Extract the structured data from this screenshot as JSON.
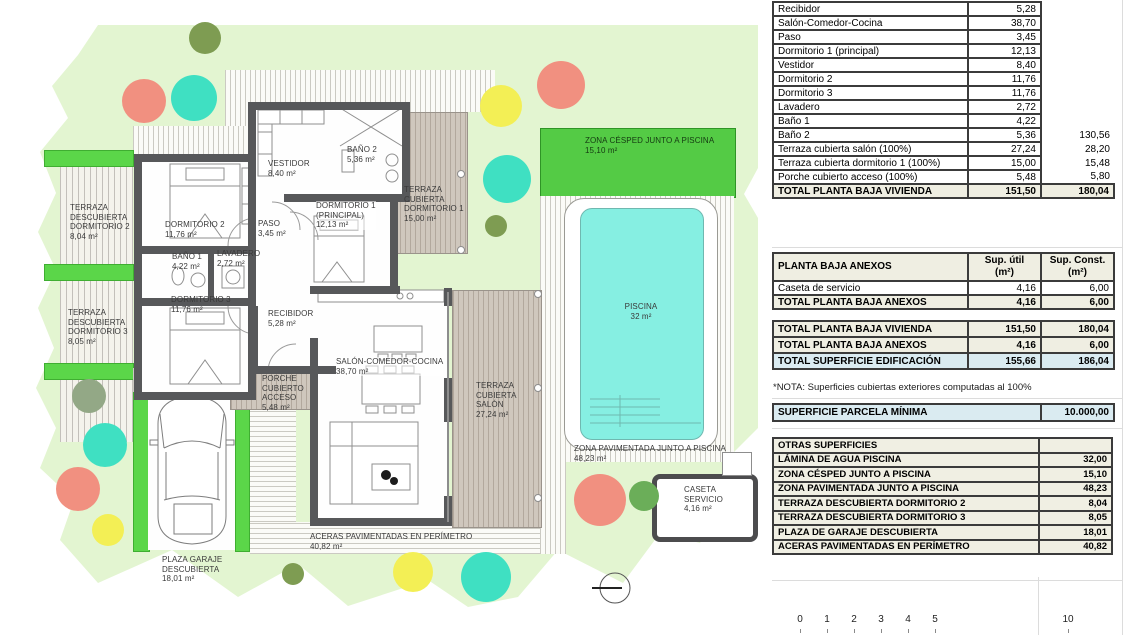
{
  "colors": {
    "parcel": "#e3f5d1",
    "cesped": "#54cb45",
    "green_bar": "#5bd649",
    "pool_water": "#86efe2",
    "wall": "#57585a",
    "roofed_terrace": "#cfc7bd",
    "table_beige": "#efeee2",
    "table_blue": "#daebf1",
    "tree_salmon": "#f19080",
    "tree_teal": "#3fe0c2",
    "tree_yellow": "#f3ef55",
    "tree_olive": "#7e9c52"
  },
  "plan": {
    "labels": {
      "terraza_d2": "TERRAZA\nDESCUBIERTA\nDORMITORIO 2\n8,04 m²",
      "terraza_d3": "TERRAZA\nDESCUBIERTA\nDORMITORIO 3\n8,05 m²",
      "dorm2": "DORMITORIO 2\n11,76 m²",
      "vestidor": "VESTIDOR\n8,40 m²",
      "bano2": "BAÑO 2\n5,36 m²",
      "paso": "PASO\n3,45 m²",
      "bano1": "BAÑO 1\n4,22 m²",
      "lavadero": "LAVADERO\n2,72 m²",
      "dorm1": "DORMITORIO 1\n(PRINCIPAL)\n12,13 m²",
      "dorm3": "DORMITORIO 3\n11,76 m²",
      "recibidor": "RECIBIDOR\n5,28 m²",
      "salon": "SALÓN-COMEDOR-COCINA\n38,70 m²",
      "porche": "PORCHE\nCUBIERTO\nACCESO\n5,48 m²",
      "terraza_salon": "TERRAZA\nCUBIERTA\nSALÓN\n27,24 m²",
      "terraza_d1": "TERRAZA\nCUBIERTA\nDORMITORIO 1\n15,00 m²",
      "cesped": "ZONA CÉSPED JUNTO A PISCINA\n15,10 m²",
      "piscina": "PISCINA\n32 m²",
      "pavimentada": "ZONA PAVIMENTADA JUNTO A PISCINA\n48,23 m²",
      "caseta": "CASETA\nSERVICIO\n4,16 m²",
      "aceras": "ACERAS PAVIMENTADAS EN PERÍMETRO\n40,82 m²",
      "garaje": "PLAZA GARAJE\nDESCUBIERTA\n18,01 m²"
    },
    "scalebar": {
      "ticks": [
        "0",
        "1",
        "2",
        "3",
        "4",
        "5",
        "10"
      ]
    }
  },
  "panel": {
    "vivienda": {
      "rows": [
        {
          "name": "Recibidor",
          "util": "5,28",
          "const": ""
        },
        {
          "name": "Salón-Comedor-Cocina",
          "util": "38,70",
          "const": ""
        },
        {
          "name": "Paso",
          "util": "3,45",
          "const": ""
        },
        {
          "name": "Dormitorio 1 (principal)",
          "util": "12,13",
          "const": ""
        },
        {
          "name": "Vestidor",
          "util": "8,40",
          "const": ""
        },
        {
          "name": "Dormitorio 2",
          "util": "11,76",
          "const": ""
        },
        {
          "name": "Dormitorio 3",
          "util": "11,76",
          "const": ""
        },
        {
          "name": "Lavadero",
          "util": "2,72",
          "const": ""
        },
        {
          "name": "Baño 1",
          "util": "4,22",
          "const": ""
        },
        {
          "name": "Baño 2",
          "util": "5,36",
          "const": "130,56"
        },
        {
          "name": "Terraza cubierta salón (100%)",
          "util": "27,24",
          "const": "28,20"
        },
        {
          "name": "Terraza cubierta dormitorio 1 (100%)",
          "util": "15,00",
          "const": "15,48"
        },
        {
          "name": "Porche cubierto acceso (100%)",
          "util": "5,48",
          "const": "5,80"
        }
      ],
      "total": {
        "name": "TOTAL PLANTA BAJA VIVIENDA",
        "util": "151,50",
        "const": "180,04"
      }
    },
    "anexos": {
      "header": {
        "name": "PLANTA BAJA ANEXOS",
        "util": "Sup. útil\n(m²)",
        "const": "Sup. Const.\n(m²)"
      },
      "row": {
        "name": "Caseta de servicio",
        "util": "4,16",
        "const": "6,00"
      },
      "total": {
        "name": "TOTAL PLANTA BAJA ANEXOS",
        "util": "4,16",
        "const": "6,00"
      }
    },
    "resumen": {
      "rows": [
        {
          "name": "TOTAL PLANTA BAJA VIVIENDA",
          "util": "151,50",
          "const": "180,04"
        },
        {
          "name": "TOTAL PLANTA BAJA ANEXOS",
          "util": "4,16",
          "const": "6,00"
        },
        {
          "name": "TOTAL SUPERFICIE EDIFICACIÓN",
          "util": "155,66",
          "const": "186,04"
        }
      ],
      "nota": "*NOTA: Superficies cubiertas exteriores computadas al 100%"
    },
    "parcela": {
      "name": "SUPERFICIE PARCELA MÍNIMA",
      "value": "10.000,00"
    },
    "otras": {
      "header": "OTRAS SUPERFICIES",
      "rows": [
        {
          "name": "LÁMINA DE AGUA PISCINA",
          "value": "32,00"
        },
        {
          "name": "ZONA CÉSPED JUNTO A PISCINA",
          "value": "15,10"
        },
        {
          "name": "ZONA PAVIMENTADA JUNTO A PISCINA",
          "value": "48,23"
        },
        {
          "name": "TERRAZA DESCUBIERTA DORMITORIO 2",
          "value": "8,04"
        },
        {
          "name": "TERRAZA DESCUBIERTA DORMITORIO 3",
          "value": "8,05"
        },
        {
          "name": "PLAZA DE GARAJE DESCUBIERTA",
          "value": "18,01"
        },
        {
          "name": "ACERAS PAVIMENTADAS EN PERÍMETRO",
          "value": "40,82"
        }
      ]
    }
  }
}
